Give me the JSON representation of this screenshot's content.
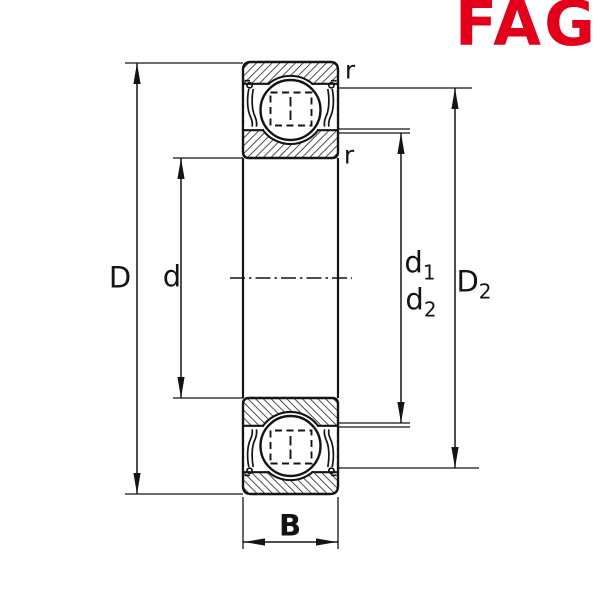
{
  "page": {
    "background": "#ffffff"
  },
  "logo": {
    "text": "FAG",
    "color": "#e2001a"
  },
  "drawing": {
    "subject": "deep groove ball bearing cross-section, shielded on both sides",
    "line_color": "#141414",
    "centerline_style": "dash-dot"
  },
  "labels": {
    "D": "D",
    "d": "d",
    "d1": {
      "base": "d",
      "sub": "1"
    },
    "d2": {
      "base": "d",
      "sub": "2"
    },
    "D2": {
      "base": "D",
      "sub": "2"
    },
    "B": "B",
    "r_outer": "r",
    "r_inner": "r"
  }
}
